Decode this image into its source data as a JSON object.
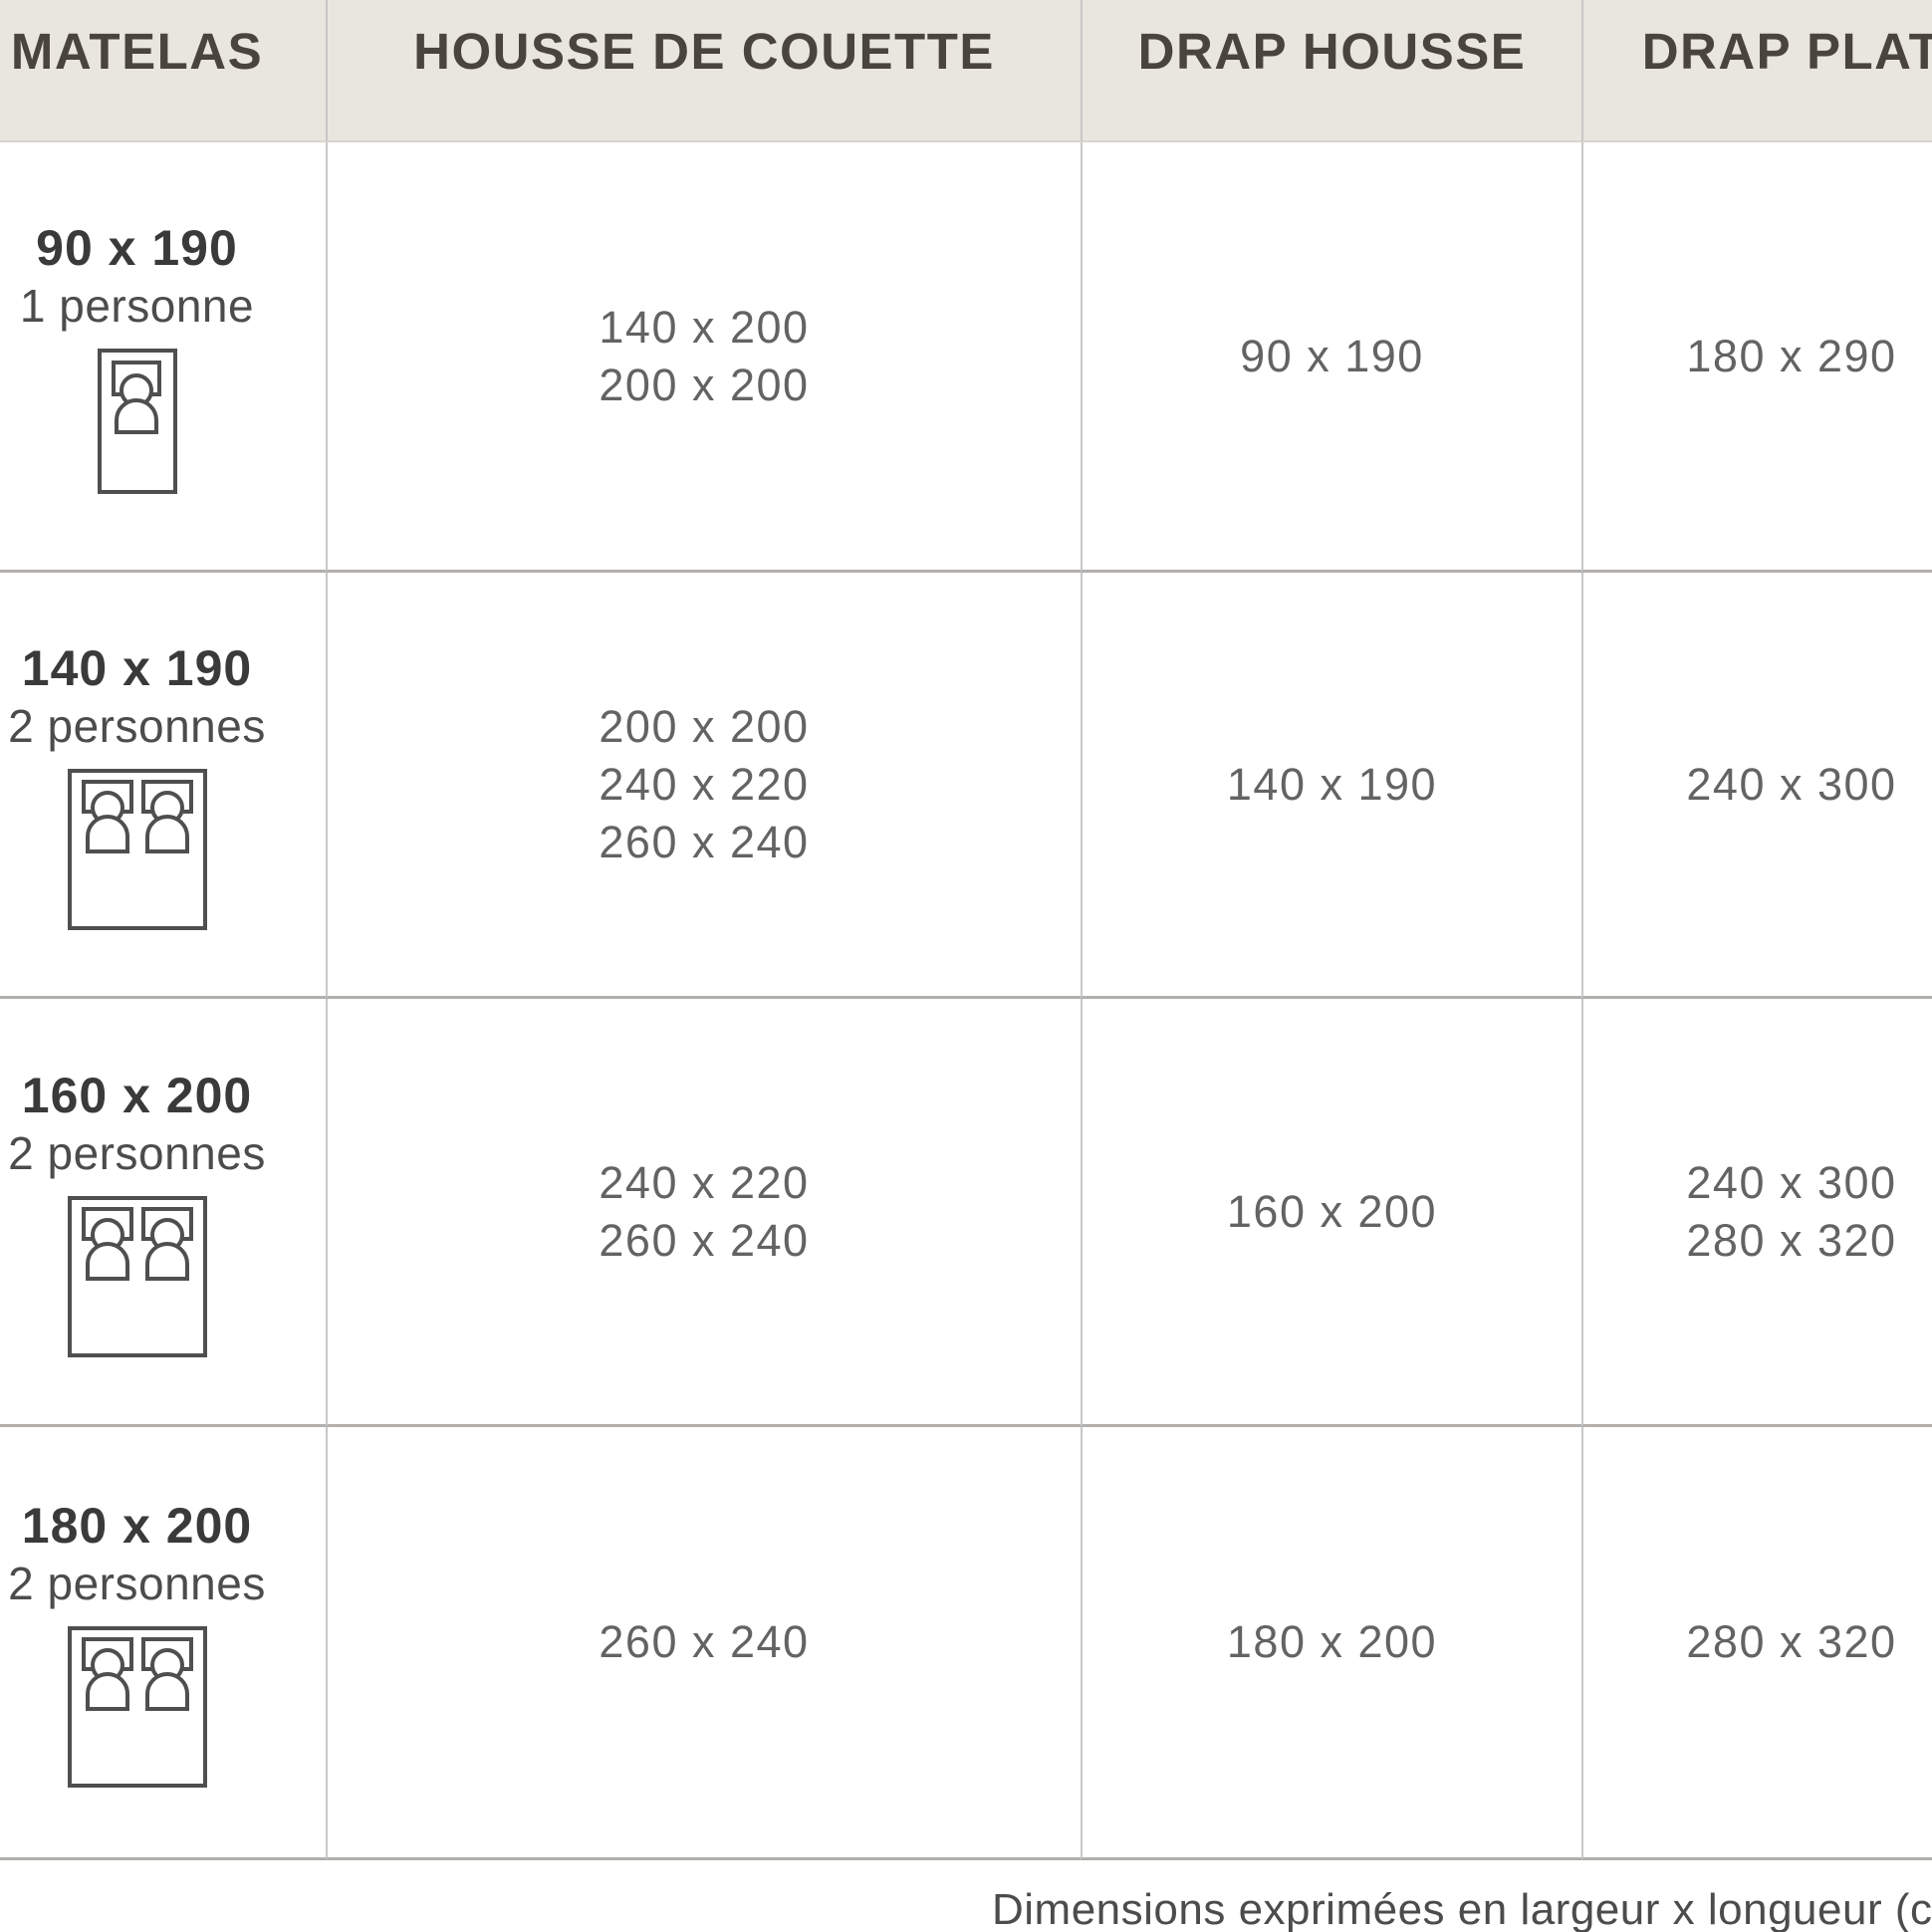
{
  "chart_data": {
    "type": "table",
    "title": "",
    "columns": [
      "MATELAS",
      "HOUSSE DE COUETTE",
      "DRAP HOUSSE",
      "DRAP PLAT"
    ],
    "rows": [
      {
        "matelas": "90 x 190",
        "personnes": "1 personne",
        "icon": "single-bed",
        "housse_de_couette": [
          "140 x 200",
          "200 x 200"
        ],
        "drap_housse": [
          "90 x 190"
        ],
        "drap_plat": [
          "180 x 290"
        ]
      },
      {
        "matelas": "140 x 190",
        "personnes": "2 personnes",
        "icon": "double-bed",
        "housse_de_couette": [
          "200 x 200",
          "240 x 220",
          "260 x 240"
        ],
        "drap_housse": [
          "140 x 190"
        ],
        "drap_plat": [
          "240 x 300"
        ]
      },
      {
        "matelas": "160 x 200",
        "personnes": "2 personnes",
        "icon": "double-bed",
        "housse_de_couette": [
          "240 x 220",
          "260 x 240"
        ],
        "drap_housse": [
          "160 x 200"
        ],
        "drap_plat": [
          "240 x 300",
          "280 x 320"
        ]
      },
      {
        "matelas": "180 x 200",
        "personnes": "2 personnes",
        "icon": "double-bed",
        "housse_de_couette": [
          "260 x 240"
        ],
        "drap_housse": [
          "180 x 200"
        ],
        "drap_plat": [
          "280 x 320"
        ]
      }
    ],
    "note": "Dimensions exprimées en largeur x longueur (cm",
    "layout": {
      "grid": "on",
      "header_position": "top"
    }
  },
  "colors": {
    "header_background": "#e9e6e0",
    "header_text": "#49453e",
    "vertical_border": "#c7c7c7",
    "horizontal_border": "#b2afac",
    "size_text": "#3a3a3a",
    "capacity_text": "#4c4c4c",
    "value_text": "#636363",
    "icon_stroke": "#4f4f4f",
    "background": "#ffffff"
  }
}
